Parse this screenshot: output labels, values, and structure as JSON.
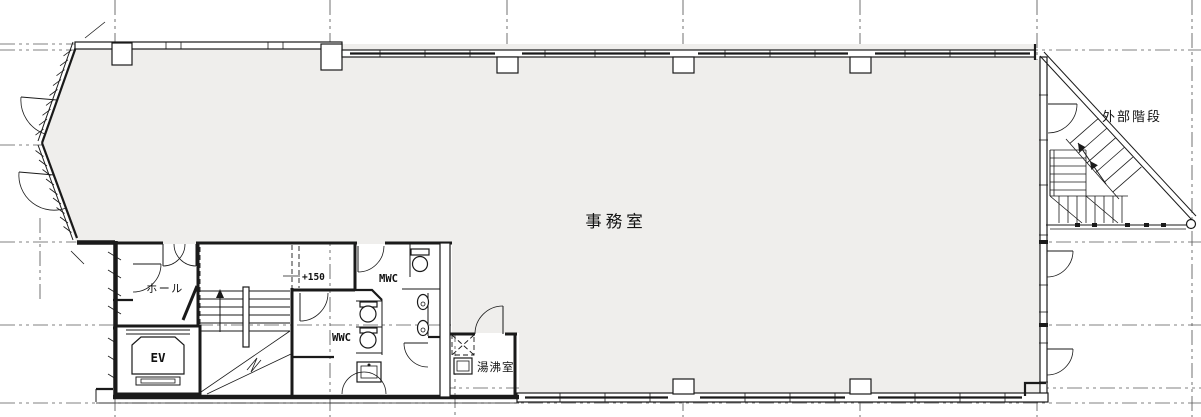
{
  "drawing": {
    "labels": {
      "office": "事務室",
      "external_stairs": "外部階段",
      "hall": "ホール",
      "elevator": "EV",
      "mens_wc": "MWC",
      "womens_wc": "WWC",
      "kitchenette": "湯沸室",
      "level_marker": "+150"
    },
    "colors": {
      "floor_fill": "#efeeec",
      "line": "#1a1a1a",
      "grid": "#5a5a5a",
      "background": "#ffffff"
    }
  }
}
